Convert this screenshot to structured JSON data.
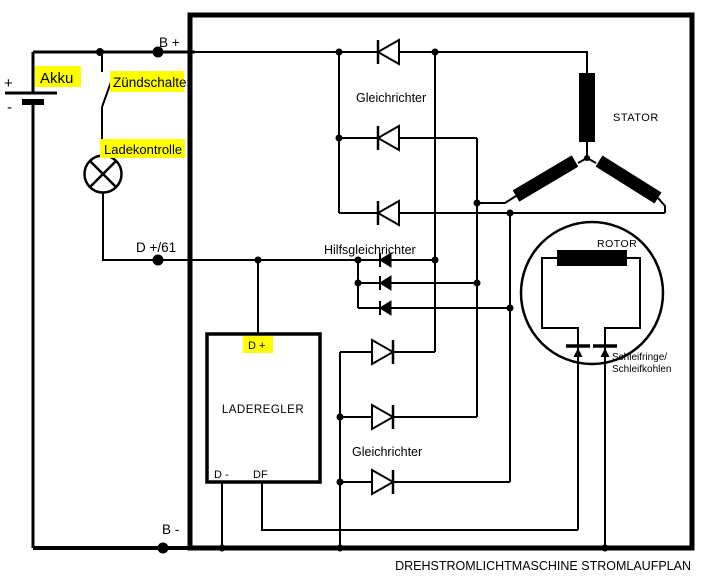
{
  "title": "DREHSTROMLICHTMASCHINE STROMLAUFPLAN",
  "colors": {
    "highlight": "#ffff00",
    "wire": "#000000",
    "background": "#ffffff"
  },
  "terminals": {
    "b_plus": "B +",
    "b_minus": "B -",
    "d_plus_61": "D +/61"
  },
  "battery": {
    "label": "Akku",
    "plus_sign": "+",
    "minus_sign": "-"
  },
  "ignition_switch": {
    "label": "Zündschalter"
  },
  "charge_lamp": {
    "label": "Ladekontrolle"
  },
  "rectifier_top": {
    "label": "Gleichrichter"
  },
  "aux_rectifier": {
    "label": "Hilfsgleichrichter"
  },
  "rectifier_bottom": {
    "label": "Gleichrichter"
  },
  "stator": {
    "label": "STATOR"
  },
  "rotor": {
    "label": "ROTOR"
  },
  "slip_rings": {
    "line1": "Schleifringe/",
    "line2": "Schleifkohlen"
  },
  "regulator": {
    "label": "LADEREGLER",
    "d_plus": "D +",
    "d_minus": "D -",
    "df": "DF"
  }
}
